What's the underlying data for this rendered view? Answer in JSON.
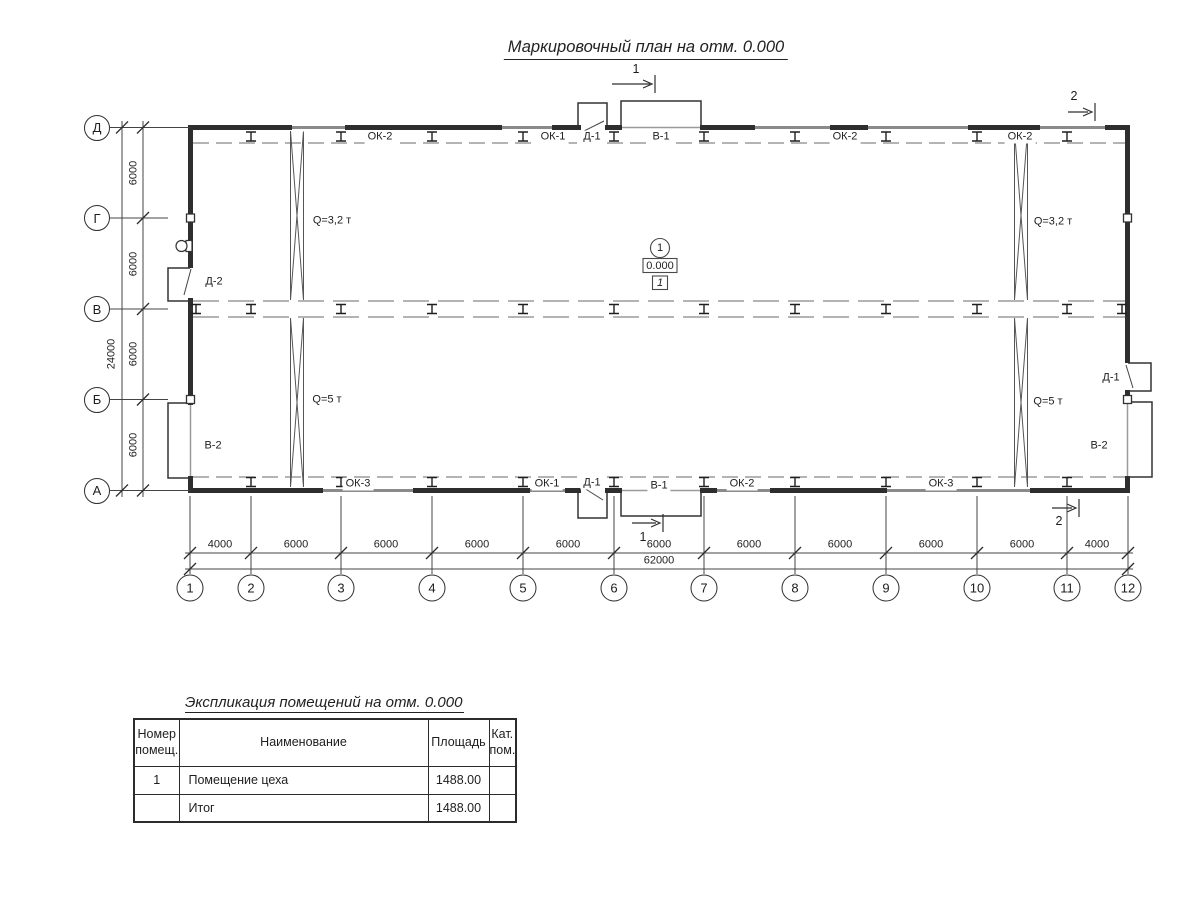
{
  "title": "Маркировочный план на отм. 0.000",
  "plan": {
    "row_axes": [
      {
        "label": "Д",
        "x": 97,
        "y": 127.5
      },
      {
        "label": "Г",
        "x": 97,
        "y": 218
      },
      {
        "label": "В",
        "x": 97,
        "y": 309
      },
      {
        "label": "Б",
        "x": 97,
        "y": 399.5
      },
      {
        "label": "А",
        "x": 97,
        "y": 490.5
      }
    ],
    "col_axes": [
      {
        "label": "1",
        "x": 190,
        "y": 588
      },
      {
        "label": "2",
        "x": 251,
        "y": 588
      },
      {
        "label": "3",
        "x": 341,
        "y": 588
      },
      {
        "label": "4",
        "x": 432,
        "y": 588
      },
      {
        "label": "5",
        "x": 523,
        "y": 588
      },
      {
        "label": "6",
        "x": 614,
        "y": 588
      },
      {
        "label": "7",
        "x": 704,
        "y": 588
      },
      {
        "label": "8",
        "x": 795,
        "y": 588
      },
      {
        "label": "9",
        "x": 886,
        "y": 588
      },
      {
        "label": "10",
        "x": 977,
        "y": 588
      },
      {
        "label": "11",
        "x": 1067,
        "y": 588
      },
      {
        "label": "12",
        "x": 1128,
        "y": 588
      }
    ],
    "v_dims": [
      {
        "text": "6000",
        "x": 134,
        "y": 173
      },
      {
        "text": "6000",
        "x": 134,
        "y": 264
      },
      {
        "text": "6000",
        "x": 134,
        "y": 354
      },
      {
        "text": "6000",
        "x": 134,
        "y": 445
      },
      {
        "text": "24000",
        "x": 112,
        "y": 354
      }
    ],
    "h_dims": [
      {
        "text": "4000",
        "x": 220,
        "y": 545
      },
      {
        "text": "6000",
        "x": 296,
        "y": 545
      },
      {
        "text": "6000",
        "x": 386,
        "y": 545
      },
      {
        "text": "6000",
        "x": 477,
        "y": 545
      },
      {
        "text": "6000",
        "x": 568,
        "y": 545
      },
      {
        "text": "6000",
        "x": 659,
        "y": 545
      },
      {
        "text": "6000",
        "x": 749,
        "y": 545
      },
      {
        "text": "6000",
        "x": 840,
        "y": 545
      },
      {
        "text": "6000",
        "x": 931,
        "y": 545
      },
      {
        "text": "6000",
        "x": 1022,
        "y": 545
      },
      {
        "text": "4000",
        "x": 1097,
        "y": 545
      }
    ],
    "total_dim": [
      {
        "text": "62000",
        "x": 659,
        "y": 561
      }
    ],
    "wall_tags_top": [
      {
        "text": "ОК-2",
        "x": 380,
        "y": 137
      },
      {
        "text": "ОК-1",
        "x": 553,
        "y": 137
      },
      {
        "text": "Д-1",
        "x": 592,
        "y": 137
      },
      {
        "text": "В-1",
        "x": 661,
        "y": 137
      },
      {
        "text": "ОК-2",
        "x": 845,
        "y": 137
      },
      {
        "text": "ОК-2",
        "x": 1020,
        "y": 137
      }
    ],
    "wall_tags_bottom": [
      {
        "text": "ОК-3",
        "x": 358,
        "y": 484
      },
      {
        "text": "ОК-1",
        "x": 547,
        "y": 484
      },
      {
        "text": "Д-1",
        "x": 592,
        "y": 483
      },
      {
        "text": "В-1",
        "x": 659,
        "y": 486
      },
      {
        "text": "ОК-2",
        "x": 742,
        "y": 484
      },
      {
        "text": "ОК-3",
        "x": 941,
        "y": 484
      }
    ],
    "wall_tags_sides": [
      {
        "text": "Д-2",
        "x": 214,
        "y": 282
      },
      {
        "text": "В-2",
        "x": 213,
        "y": 446
      },
      {
        "text": "Д-1",
        "x": 1111,
        "y": 378
      },
      {
        "text": "В-2",
        "x": 1099,
        "y": 446
      }
    ],
    "crane_labels": [
      {
        "text": "Q=3,2 т",
        "x": 332,
        "y": 221
      },
      {
        "text": "Q=5 т",
        "x": 327,
        "y": 400
      },
      {
        "text": "Q=3,2 т",
        "x": 1053,
        "y": 222
      },
      {
        "text": "Q=5 т",
        "x": 1048,
        "y": 402
      }
    ],
    "section_labels": [
      {
        "text": "1",
        "x": 636,
        "y": 69
      },
      {
        "text": "1",
        "x": 643,
        "y": 537
      },
      {
        "text": "2",
        "x": 1074,
        "y": 96
      },
      {
        "text": "2",
        "x": 1059,
        "y": 521
      }
    ],
    "room_marker": {
      "number": "1",
      "elevation": "0.000",
      "tag": "1",
      "x": 660,
      "cy": 248,
      "ey": 265.5,
      "ty": 282.5
    }
  },
  "table": {
    "title": "Экспликация помещений на отм. 0.000",
    "headers": [
      "Номер\nпомещ.",
      "Наименование",
      "Площадь",
      "Кат.\nпом."
    ],
    "rows": [
      [
        "1",
        "Помещение цеха",
        "1488.00",
        ""
      ],
      [
        "",
        "Итог",
        "1488.00",
        ""
      ]
    ]
  }
}
